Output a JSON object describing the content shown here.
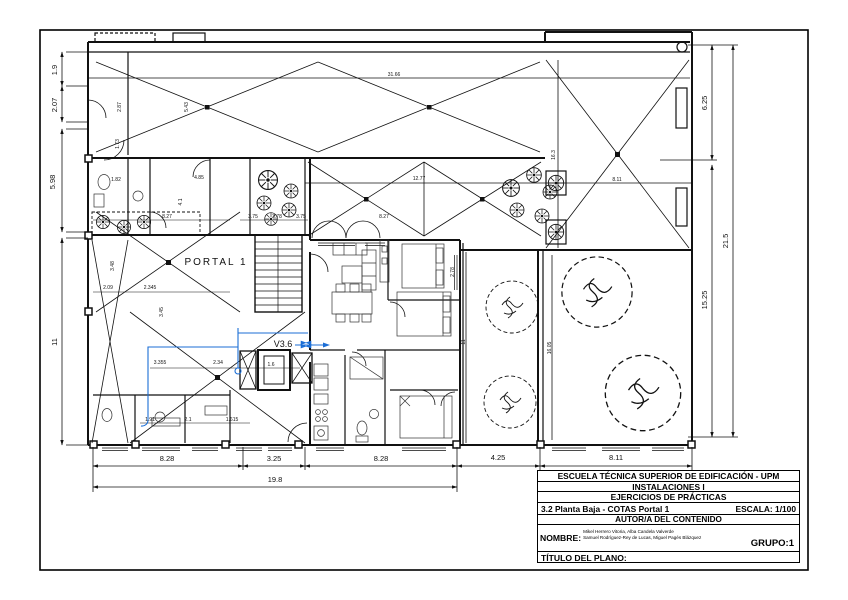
{
  "title_block": {
    "school": "ESCUELA TÉCNICA SUPERIOR DE EDIFICACIÓN - UPM",
    "course": "INSTALACIONES I",
    "section": "EJERCICIOS DE PRÁCTICAS",
    "sheet": "3.2 Planta Baja - COTAS Portal 1",
    "scale": "ESCALA: 1/100",
    "authorship": "AUTOR/A DEL CONTENIDO",
    "name_label": "NOMBRE:",
    "names_line1": "Mikel Herrero Vitoria, Alba Candela Valverde",
    "names_line2": "Samuel Rodríguez-Rey de Lucas, Miguel Pagés Blázquez",
    "group": "GRUPO:1",
    "plan_title_label": "TÍTULO DEL PLANO:"
  },
  "colors": {
    "line": "#111111",
    "annotation_blue": "#1b6ed6"
  },
  "plan": {
    "portal_label": "PORTAL 1",
    "valve_label": "V3.6",
    "labels": [
      {
        "t": "1.9",
        "x": 57,
        "y": 70,
        "r": -90,
        "s": 7.5
      },
      {
        "t": "2.07",
        "x": 57,
        "y": 105,
        "r": -90,
        "s": 7.5
      },
      {
        "t": "5.98",
        "x": 55,
        "y": 182,
        "r": -90,
        "s": 7.5
      },
      {
        "t": "11",
        "x": 57,
        "y": 342,
        "r": -90,
        "s": 7.5
      },
      {
        "t": "6.25",
        "x": 707,
        "y": 103,
        "r": -90,
        "s": 7.5
      },
      {
        "t": "15.25",
        "x": 707,
        "y": 300,
        "r": -90,
        "s": 7.5
      },
      {
        "t": "21.5",
        "x": 728,
        "y": 241,
        "r": -90,
        "s": 7.5
      },
      {
        "t": "8.28",
        "x": 167,
        "y": 461,
        "s": 7.5
      },
      {
        "t": "3.25",
        "x": 274,
        "y": 461,
        "s": 7.5
      },
      {
        "t": "8.28",
        "x": 381,
        "y": 461,
        "s": 7.5
      },
      {
        "t": "4.25",
        "x": 498,
        "y": 460,
        "s": 7.5
      },
      {
        "t": "8.11",
        "x": 616,
        "y": 460,
        "s": 7.5
      },
      {
        "t": "19.8",
        "x": 275,
        "y": 482,
        "s": 7.5
      },
      {
        "t": "PORTAL 1",
        "x": 216,
        "y": 265,
        "s": 10,
        "ls": 2
      },
      {
        "t": "V3.6",
        "x": 283,
        "y": 347,
        "s": 9
      },
      {
        "t": "31.66",
        "x": 394,
        "y": 76,
        "s": 5
      },
      {
        "t": "12.77",
        "x": 419,
        "y": 180,
        "s": 5
      },
      {
        "t": "8.27",
        "x": 384,
        "y": 218,
        "s": 5
      },
      {
        "t": "8.27",
        "x": 167,
        "y": 218,
        "s": 5
      },
      {
        "t": "8.11",
        "x": 617,
        "y": 181,
        "s": 5
      },
      {
        "t": "16.3",
        "x": 555,
        "y": 155,
        "r": -90,
        "s": 5
      },
      {
        "t": "16.05",
        "x": 551,
        "y": 348,
        "r": -90,
        "s": 5
      },
      {
        "t": "11",
        "x": 465,
        "y": 342,
        "r": -90,
        "s": 5
      },
      {
        "t": "2.78",
        "x": 454,
        "y": 272,
        "r": -90,
        "s": 5
      },
      {
        "t": "1.82",
        "x": 116,
        "y": 181,
        "s": 5
      },
      {
        "t": "2.87",
        "x": 121,
        "y": 107,
        "r": -90,
        "s": 5
      },
      {
        "t": "1.73",
        "x": 119,
        "y": 144,
        "r": -90,
        "s": 5
      },
      {
        "t": "5.43",
        "x": 188,
        "y": 107,
        "r": -90,
        "s": 5
      },
      {
        "t": "4.85",
        "x": 199,
        "y": 179,
        "s": 5
      },
      {
        "t": "4.1",
        "x": 182,
        "y": 202,
        "r": -90,
        "s": 5
      },
      {
        "t": "3.48",
        "x": 114,
        "y": 266,
        "r": -90,
        "s": 5
      },
      {
        "t": "3.45",
        "x": 163,
        "y": 312,
        "r": -90,
        "s": 5
      },
      {
        "t": "2.09",
        "x": 108,
        "y": 289,
        "s": 5
      },
      {
        "t": "2.345",
        "x": 150,
        "y": 289,
        "s": 5
      },
      {
        "t": "3.75",
        "x": 253,
        "y": 218,
        "s": 5
      },
      {
        "t": "3.78",
        "x": 277,
        "y": 218,
        "s": 5
      },
      {
        "t": "3.75",
        "x": 301,
        "y": 218,
        "s": 5
      },
      {
        "t": "3.355",
        "x": 160,
        "y": 364,
        "s": 5
      },
      {
        "t": "2.34",
        "x": 218,
        "y": 364,
        "s": 5
      },
      {
        "t": "1.6",
        "x": 271,
        "y": 366,
        "s": 5
      },
      {
        "t": "1.91",
        "x": 150,
        "y": 421,
        "s": 5
      },
      {
        "t": "2.1",
        "x": 188,
        "y": 421,
        "s": 5
      },
      {
        "t": "1.615",
        "x": 232,
        "y": 421,
        "s": 5
      }
    ]
  }
}
